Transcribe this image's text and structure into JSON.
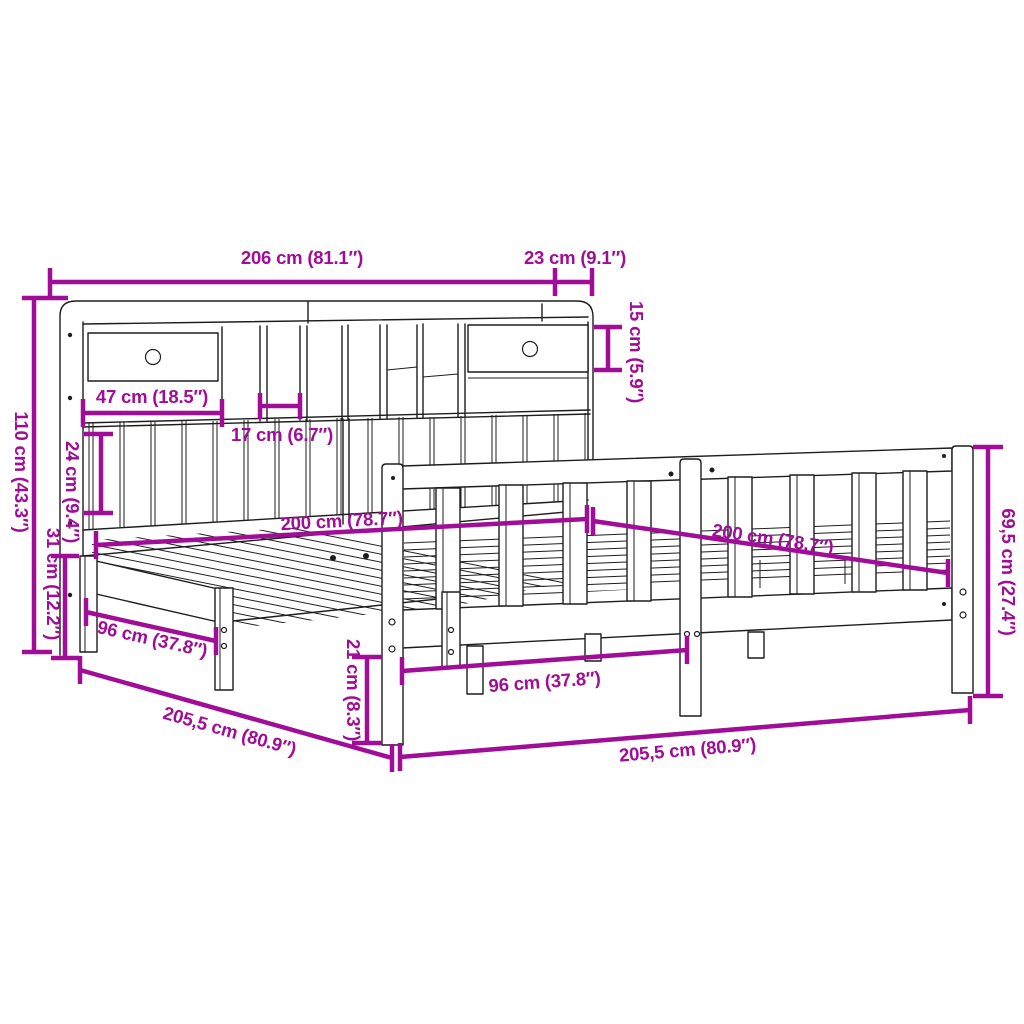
{
  "figure": {
    "type": "product-dimension-diagram",
    "subject": "bookcase-headboard bed frame line drawing with measurements"
  },
  "colors": {
    "dimension_accent": "#A00D96",
    "line_art": "#1d1d1d",
    "background": "#ffffff"
  },
  "dimensions": {
    "bookcase_width": "206 cm (81.1″)",
    "bookcase_depth": "23 cm (9.1″)",
    "top_shelf_height": "15 cm (5.9″)",
    "headboard_height": "110 cm (43.3″)",
    "drawer_width": "47 cm (18.5″)",
    "compartment_width": "17 cm (6.7″)",
    "lower_panel_height": "24 cm (9.4″)",
    "frame_side_height": "31 cm (12.2″)",
    "bed_length_left": "200 cm (78.7″)",
    "bed_length_right": "200 cm (78.7″)",
    "leg_distance_left": "96 cm (37.8″)",
    "leg_distance_right": "96 cm (37.8″)",
    "under_bed_clearance": "21 cm (8.3″)",
    "total_length_left": "205,5 cm (80.9″)",
    "total_length_right": "205,5 cm (80.9″)",
    "footboard_height": "69,5 cm (27.4″)"
  }
}
